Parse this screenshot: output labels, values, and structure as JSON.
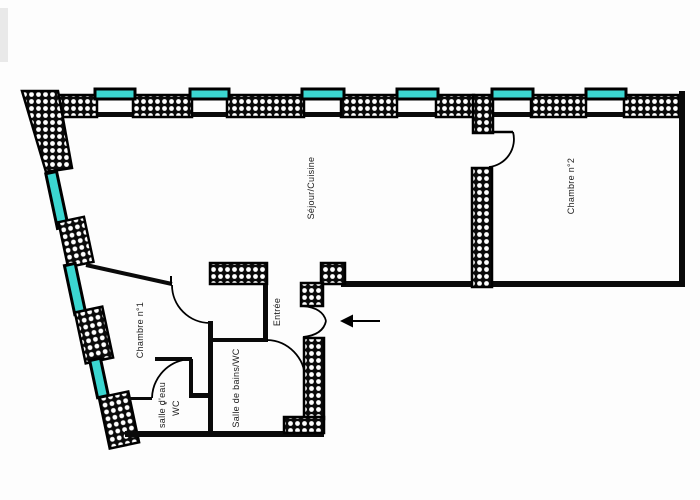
{
  "floorplan": {
    "title": "Plan d'appartement",
    "rooms": [
      {
        "id": "sejour-cuisine",
        "label": "Séjour/Cuisine"
      },
      {
        "id": "chambre-2",
        "label": "Chambre n°2"
      },
      {
        "id": "chambre-1",
        "label": "Chambre n°1"
      },
      {
        "id": "entree",
        "label": "Entrée"
      },
      {
        "id": "salle-de-bains",
        "label": "Salle de bains/WC"
      },
      {
        "id": "salle-d-eau",
        "label": "salle d'eau"
      },
      {
        "id": "wc",
        "label": "WC"
      },
      {
        "id": "wc-note",
        "label": "*"
      }
    ],
    "icons": {
      "entrance_arrow": "arrow-left"
    },
    "colors": {
      "window": "#3BD6D0",
      "wall": "#0a0a0a",
      "background": "#fdfdfd"
    }
  }
}
